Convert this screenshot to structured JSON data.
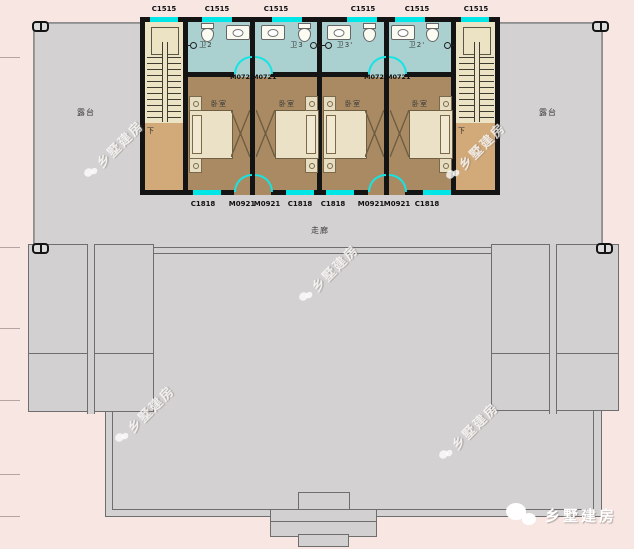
{
  "drawing": {
    "terrace_left": "露台",
    "terrace_right": "露台",
    "corridor": "走廊",
    "stair_down_left": "下",
    "stair_down_right": "下",
    "top_window_labels": [
      "C1515",
      "C1515",
      "C1515",
      "C1515",
      "C1515",
      "C1515"
    ],
    "bath_door_labels": [
      "M0721",
      "M0721",
      "M0721",
      "M0721"
    ],
    "bottom_labels": [
      "C1818",
      "M0921",
      "M0921",
      "C1818",
      "C1818",
      "M0921",
      "M0921",
      "C1818"
    ],
    "units": [
      {
        "bath": "卫2",
        "bedroom": "卧室"
      },
      {
        "bath": "卫3",
        "bedroom": "卧室"
      },
      {
        "bath": "卫3'",
        "bedroom": "卧室"
      },
      {
        "bath": "卫2'",
        "bedroom": "卧室"
      }
    ],
    "watermark": "乡墅建房",
    "footer_brand": "乡墅建房",
    "colors": {
      "background": "#f8e6e3",
      "paving_gray": "#d3d1d2",
      "bedroom_floor": "#a98a62",
      "bath_floor": "#abd0d0",
      "stair_floor": "#ece2c4",
      "landing_floor": "#d2aa79",
      "window_cyan": "#00e6e6",
      "wall": "#141414"
    }
  }
}
